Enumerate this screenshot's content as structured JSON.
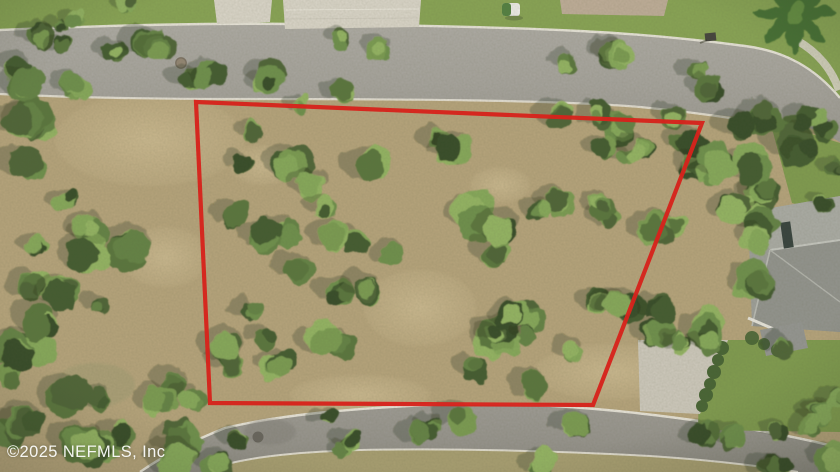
{
  "meta": {
    "type": "aerial-photograph",
    "subject": "Drone aerial view of a wooded vacant residential lot outlined in red, bounded by a street at top and a curving street at bottom, house roof at right"
  },
  "watermark": {
    "text": "©2025 NEFMLS, Inc"
  },
  "boundary": {
    "points": "196,102 702,123 593,405 210,403",
    "color": "#e01410",
    "stroke_width": 4.2
  },
  "palette": {
    "asphalt_top": "#a3a19c",
    "asphalt_bottom": "#92908b",
    "asphalt_shade": "#7e7c77",
    "curb": "#ebe8df",
    "sidewalk": "#d8d4c8",
    "lawn": "#83a150",
    "lawn_dark": "#7a984a",
    "dry_grass": "#a49b6e",
    "dirt": "#b3a179",
    "dirt_light": "#c4b289",
    "pavers_light": "#d9d5ca",
    "pavers_tan": "#bcab97",
    "roof_light": "#a7a9a4",
    "roof_mid": "#9a9c98",
    "roof_dark": "#8e908c",
    "roof_ridge": "#c3c5c0",
    "roof_window": "#2e3b38",
    "eave": "#e8e6df",
    "hedge": "#3f5e2e",
    "gravel": "#ccc8bd",
    "manhole": "#45423c",
    "manhole_rust": "#8a7a66",
    "palm": "#3e6b2d",
    "palm_light": "#5d8a3c",
    "canopy": [
      "#2e4521",
      "#3a5429",
      "#465f30",
      "#527137",
      "#5d7e3f",
      "#688c46",
      "#74984d"
    ],
    "canopy_light": [
      "#81a656",
      "#8fb25f"
    ],
    "shadow": "#1f2a15"
  }
}
